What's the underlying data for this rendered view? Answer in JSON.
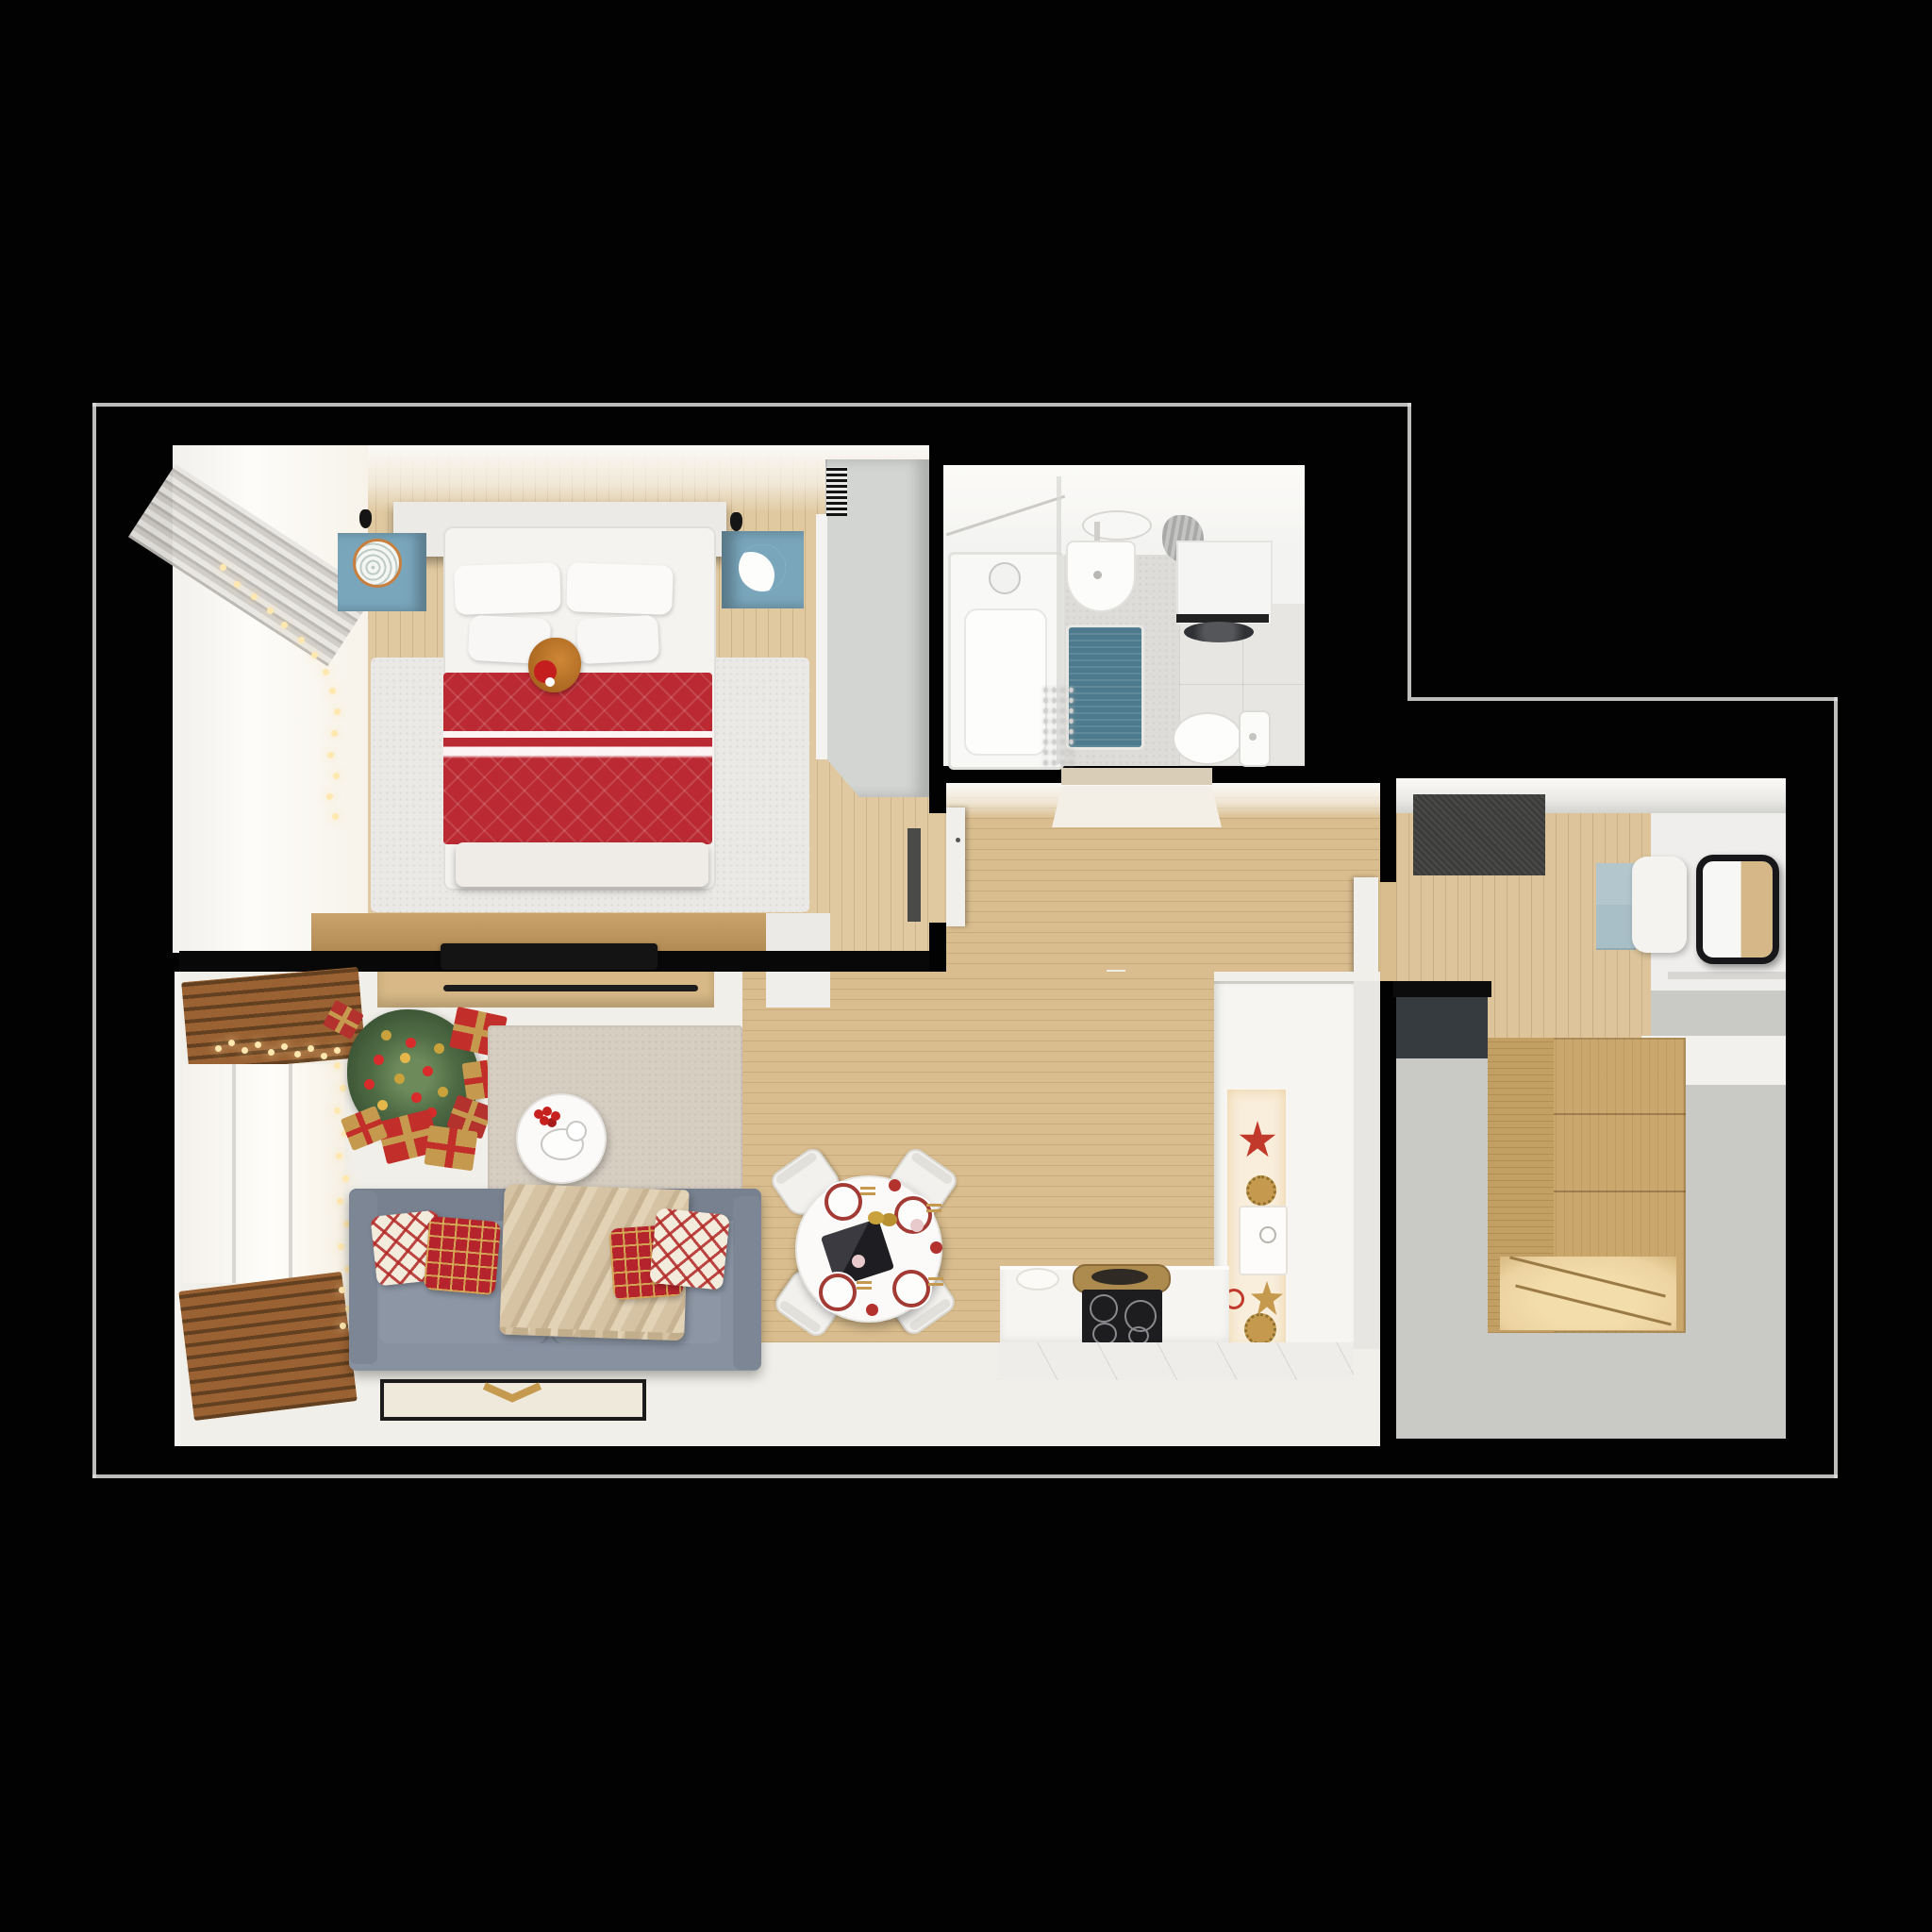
{
  "meta": {
    "type": "3d-floor-plan-render",
    "view": "top-down cutaway",
    "description": "Top-down 3D render of a one-bedroom apartment decorated for Christmas, black background, white outline around exterior walls"
  },
  "palette": {
    "black": "#020202",
    "outline": "#dededc",
    "wood": "#d9bd8e",
    "woodBedroom": "#e0c9a0",
    "woodConsole": "#c9a36b",
    "woodDrawer": "#d7b886",
    "woodAlcove": "#c9a76d",
    "woodAlcoveLit": "#ecd3a1",
    "blinds": "#9a6233",
    "blindsDark": "#63401f",
    "floorLiving": "#f1efe9",
    "floorBath": "#f3f3f1",
    "tile": "#e7e6e3",
    "tileMosaic": "#dddcd8",
    "rugLiving": "#d7cec2",
    "rugBedroom": "#eae9e5",
    "floorWing": "#c9c9c6",
    "matDark": "#3c3c3a",
    "panelCharcoal": "#363b40",
    "sofa": "#8791a0",
    "sofaDark": "#77818f",
    "pillowRed": "#b5242c",
    "throw": "#d6c3a4",
    "bedRed": "#bb2a33",
    "bedWhite": "#f4f3f0",
    "nightstandBlue": "#7aa6bc",
    "wardrobe": "#d3d5d3",
    "mirrorFrame": "#17171a",
    "cabinetBlue": "#a9bfc7",
    "treeGreen": "#4e6b45",
    "giftRed": "#c22f2a",
    "giftGold": "#c59a4e",
    "counter": "#f6f5f2",
    "counterLit": "#f9eedb",
    "stove": "#1d1d1f",
    "brass": "#ad8b4e",
    "bathMat": "#4d7a8c",
    "doorWhite": "#f1efec",
    "lightWarm": "#ffe8b0"
  },
  "rooms": [
    {
      "name": "bedroom",
      "furniture": [
        "double-bed",
        "headboard-shelf",
        "pillows",
        "red-quilted-blanket",
        "cat-with-santa-hat",
        "left-nightstand-with-rattan-plate",
        "right-nightstand-with-moon-lamp",
        "ceiling-spotlights",
        "wardrobe",
        "radiator-grille",
        "white-rug",
        "wood-floor",
        "curtains",
        "window",
        "string-lights",
        "tv-console",
        "wall-tv"
      ]
    },
    {
      "name": "bathroom",
      "furniture": [
        "bathtub",
        "shower-screen",
        "shower-set",
        "washbasin",
        "oval-mirror",
        "towel",
        "washing-machine",
        "wall-cabinet",
        "toilet",
        "teal-bath-mat",
        "mosaic-tile-floor",
        "tinsel-garland"
      ]
    },
    {
      "name": "hallway",
      "furniture": [
        "wood-floor",
        "bedroom-door",
        "bathroom-door",
        "entry-door-to-hall",
        "recessed-light-panel"
      ]
    },
    {
      "name": "living-room",
      "furniture": [
        "gray-sofa",
        "red-ornament-pillows",
        "beige-throw-blanket",
        "round-coffee-table",
        "christmas-tree",
        "gift-boxes",
        "beige-area-rug",
        "wooden-blinds",
        "string-lights",
        "framed-floor-mat",
        "media-dresser"
      ]
    },
    {
      "name": "kitchen-dining",
      "furniture": [
        "round-dining-table",
        "four-white-chairs",
        "holiday-table-setting",
        "laptop",
        "l-shaped-counter",
        "induction-hob",
        "counter-sink",
        "brass-pan",
        "tall-cabinet-column",
        "christmas-stars",
        "white-tile-floor"
      ]
    },
    {
      "name": "entry-hall",
      "furniture": [
        "charcoal-doormat",
        "wood-floor",
        "blue-console",
        "white-pouf",
        "black-framed-mirror",
        "wall-shelf",
        "charcoal-panel",
        "wood-storage-alcove",
        "gray-floor"
      ]
    }
  ]
}
